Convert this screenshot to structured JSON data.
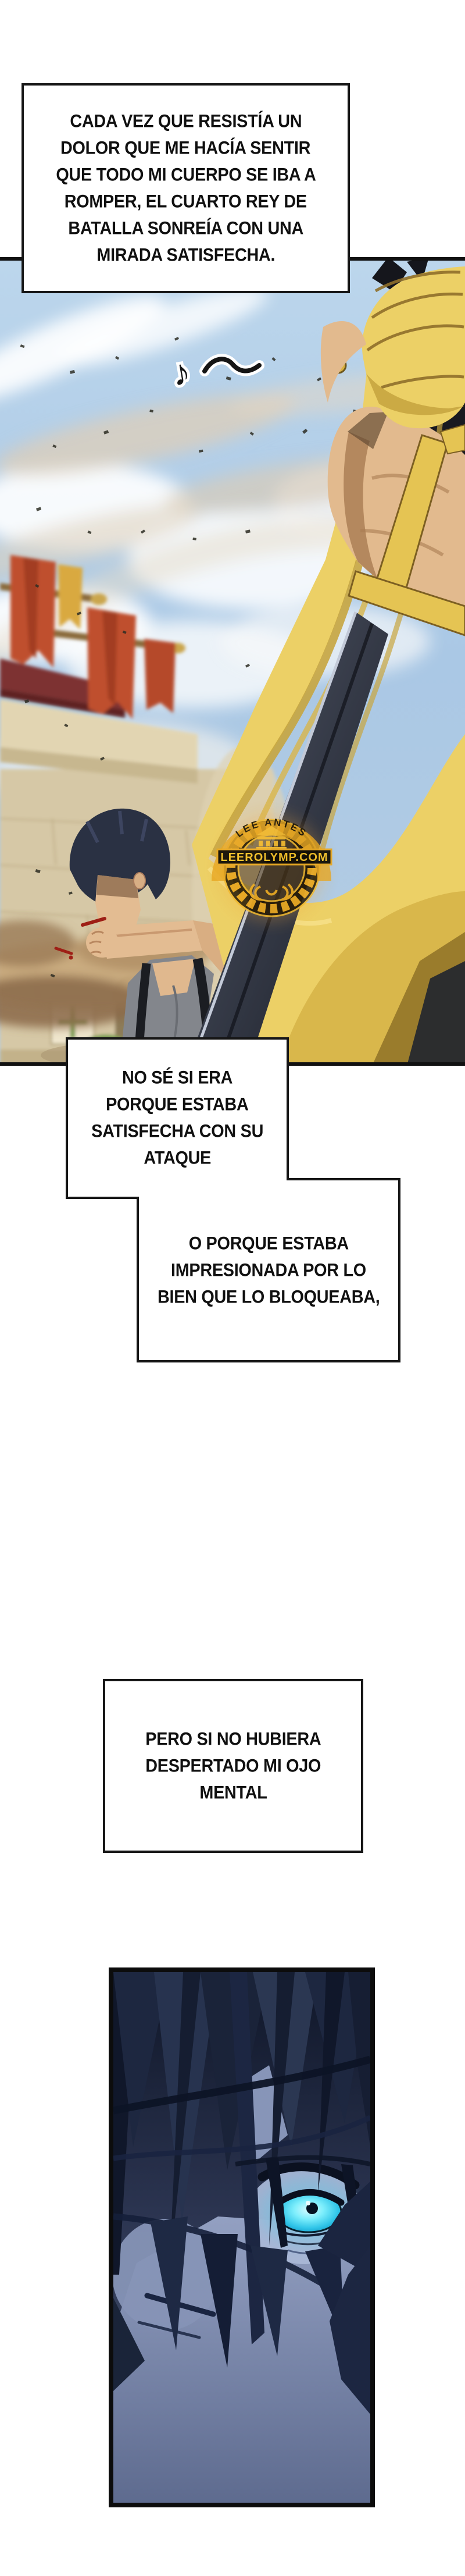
{
  "page": {
    "bg": "#ffffff"
  },
  "narration": {
    "box1": {
      "lines": [
        "CADA VEZ QUE RESISTÍA UN",
        "DOLOR QUE ME HACÍA SENTIR",
        "QUE TODO MI CUERPO SE IBA A",
        "ROMPER, EL CUARTO REY DE",
        "BATALLA SONREÍA CON UNA",
        "MIRADA SATISFECHA."
      ]
    },
    "box2": {
      "lines": [
        "NO SÉ SI ERA",
        "PORQUE ESTABA",
        "SATISFECHA CON SU",
        "ATAQUE"
      ]
    },
    "box3": {
      "lines": [
        "O PORQUE ESTABA",
        "IMPRESIONADA POR LO",
        "BIEN QUE LO BLOQUEABA,"
      ]
    },
    "box4": {
      "lines": [
        "PERO SI NO HUBIERA",
        "DESPERTADO MI OJO",
        "MENTAL"
      ]
    }
  },
  "watermark": {
    "arc_text": "LEE ANTES",
    "site": "LEEROLYMP.COM"
  },
  "sfx": {
    "note": "♪"
  },
  "colors": {
    "scarf_yellow": "#ecd066",
    "banner_red": "#bf4f2e",
    "eye_cyan": "#3fd4f0",
    "logo_gold": "#e7a722"
  }
}
